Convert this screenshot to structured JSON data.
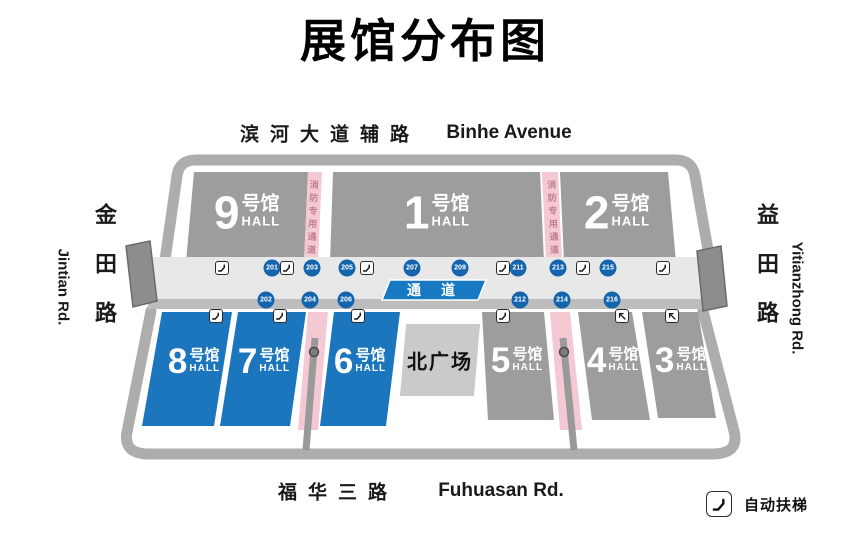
{
  "title": "展馆分布图",
  "roads": {
    "top_zh": "滨河大道辅路",
    "top_en": "Binhe Avenue",
    "bottom_zh": "福华三路",
    "bottom_en": "Fuhuasan Rd.",
    "left_zh": "金田路",
    "left_en": "Jintian Rd.",
    "right_zh": "益田路",
    "right_en": "Yitianzhong Rd."
  },
  "halls": {
    "h9": {
      "number": "9",
      "suffix": "号馆",
      "label": "HALL"
    },
    "h1": {
      "number": "1",
      "suffix": "号馆",
      "label": "HALL"
    },
    "h2": {
      "number": "2",
      "suffix": "号馆",
      "label": "HALL"
    },
    "h8": {
      "number": "8",
      "suffix": "号馆",
      "label": "HALL"
    },
    "h7": {
      "number": "7",
      "suffix": "号馆",
      "label": "HALL"
    },
    "h6": {
      "number": "6",
      "suffix": "号馆",
      "label": "HALL"
    },
    "h5": {
      "number": "5",
      "suffix": "号馆",
      "label": "HALL"
    },
    "h4": {
      "number": "4",
      "suffix": "号馆",
      "label": "HALL"
    },
    "h3": {
      "number": "3",
      "suffix": "号馆",
      "label": "HALL"
    }
  },
  "plaza": "北广场",
  "corridor": {
    "label": "通 道",
    "gates_top": [
      "201",
      "203",
      "205",
      "207",
      "209",
      "211",
      "213",
      "215"
    ],
    "gates_bottom": [
      "202",
      "204",
      "206",
      "212",
      "214",
      "216"
    ]
  },
  "fire_lane": "消防专用通道",
  "legend": {
    "escalator_label": "自动扶梯"
  },
  "colors": {
    "hall_gray": "#9d9d9d",
    "hall_blue": "#1b76bd",
    "gate_blue": "#1465ae",
    "banner_blue": "#1779c1",
    "fire_pink": "#f4c9d4",
    "road_gray": "#adadad",
    "plaza_gray": "#cacaca"
  }
}
